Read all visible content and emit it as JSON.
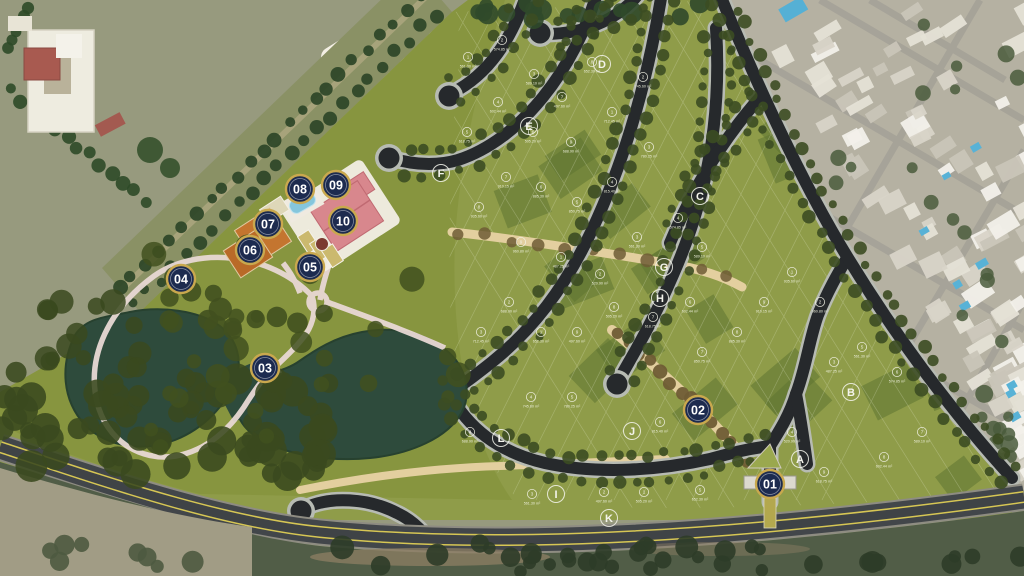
{
  "map": {
    "kind": "residential-masterplan-aerial",
    "colors": {
      "marker_fill": "#1d2b4f",
      "marker_ring": "#c9a84e",
      "marker_text": "#ffffff",
      "lot_light": "#93a248",
      "lot_dark": "#5f7531",
      "road_asphalt": "#26292c",
      "road_curb": "#b7bbb3",
      "main_road": "#42464a",
      "road_line_yellow": "#d6c654",
      "path_tan": "#e3cf9f",
      "water": "#2e4b3c",
      "roof_pink": "#d8878d",
      "court_orange": "#c4752f",
      "pool_blue": "#85c6dc",
      "white_path": "#ecddd6"
    },
    "markers": [
      {
        "id": "01",
        "x": 770,
        "y": 484
      },
      {
        "id": "02",
        "x": 698,
        "y": 410
      },
      {
        "id": "03",
        "x": 265,
        "y": 368
      },
      {
        "id": "04",
        "x": 181,
        "y": 279
      },
      {
        "id": "05",
        "x": 310,
        "y": 267
      },
      {
        "id": "06",
        "x": 250,
        "y": 250
      },
      {
        "id": "07",
        "x": 268,
        "y": 224
      },
      {
        "id": "08",
        "x": 300,
        "y": 189
      },
      {
        "id": "09",
        "x": 336,
        "y": 185
      },
      {
        "id": "10",
        "x": 343,
        "y": 221
      }
    ],
    "blocks": [
      {
        "id": "A",
        "x": 800,
        "y": 459
      },
      {
        "id": "B",
        "x": 851,
        "y": 392
      },
      {
        "id": "C",
        "x": 700,
        "y": 196
      },
      {
        "id": "D",
        "x": 602,
        "y": 64
      },
      {
        "id": "E",
        "x": 529,
        "y": 126
      },
      {
        "id": "F",
        "x": 441,
        "y": 173
      },
      {
        "id": "G",
        "x": 664,
        "y": 267
      },
      {
        "id": "H",
        "x": 660,
        "y": 298
      },
      {
        "id": "I",
        "x": 556,
        "y": 494
      },
      {
        "id": "J",
        "x": 632,
        "y": 431
      },
      {
        "id": "K",
        "x": 609,
        "y": 518
      },
      {
        "id": "L",
        "x": 501,
        "y": 438
      }
    ],
    "lots": [
      {
        "n": "1",
        "area": "561.30 m²",
        "x": 468,
        "y": 57
      },
      {
        "n": "2",
        "area": "574.85 m²",
        "x": 502,
        "y": 40
      },
      {
        "n": "3",
        "area": "589.10 m²",
        "x": 534,
        "y": 74
      },
      {
        "n": "4",
        "area": "602.44 m²",
        "x": 498,
        "y": 102
      },
      {
        "n": "5",
        "area": "618.75 m²",
        "x": 467,
        "y": 132
      },
      {
        "n": "6",
        "area": "505.20 m²",
        "x": 533,
        "y": 132
      },
      {
        "n": "7",
        "area": "497.60 m²",
        "x": 562,
        "y": 97
      },
      {
        "n": "8",
        "area": "652.30 m²",
        "x": 592,
        "y": 62
      },
      {
        "n": "9",
        "area": "688.90 m²",
        "x": 571,
        "y": 142
      },
      {
        "n": "1",
        "area": "712.45 m²",
        "x": 612,
        "y": 112
      },
      {
        "n": "2",
        "area": "745.60 m²",
        "x": 643,
        "y": 77
      },
      {
        "n": "3",
        "area": "780.25 m²",
        "x": 649,
        "y": 147
      },
      {
        "n": "4",
        "area": "815.40 m²",
        "x": 612,
        "y": 182
      },
      {
        "n": "5",
        "area": "850.75 m²",
        "x": 577,
        "y": 202
      },
      {
        "n": "6",
        "area": "885.30 m²",
        "x": 541,
        "y": 187
      },
      {
        "n": "7",
        "area": "910.15 m²",
        "x": 506,
        "y": 177
      },
      {
        "n": "8",
        "area": "935.60 m²",
        "x": 479,
        "y": 207
      },
      {
        "n": "9",
        "area": "960.80 m²",
        "x": 521,
        "y": 242
      },
      {
        "n": "1",
        "area": "487.25 m²",
        "x": 561,
        "y": 257
      },
      {
        "n": "2",
        "area": "520.90 m²",
        "x": 600,
        "y": 274
      },
      {
        "n": "3",
        "area": "561.30 m²",
        "x": 637,
        "y": 237
      },
      {
        "n": "4",
        "area": "574.85 m²",
        "x": 678,
        "y": 218
      },
      {
        "n": "5",
        "area": "589.10 m²",
        "x": 702,
        "y": 247
      },
      {
        "n": "6",
        "area": "602.44 m²",
        "x": 690,
        "y": 302
      },
      {
        "n": "7",
        "area": "618.75 m²",
        "x": 653,
        "y": 317
      },
      {
        "n": "8",
        "area": "505.20 m²",
        "x": 614,
        "y": 307
      },
      {
        "n": "9",
        "area": "497.60 m²",
        "x": 577,
        "y": 332
      },
      {
        "n": "1",
        "area": "652.30 m²",
        "x": 541,
        "y": 332
      },
      {
        "n": "2",
        "area": "688.90 m²",
        "x": 509,
        "y": 302
      },
      {
        "n": "3",
        "area": "712.45 m²",
        "x": 481,
        "y": 332
      },
      {
        "n": "4",
        "area": "745.60 m²",
        "x": 531,
        "y": 397
      },
      {
        "n": "5",
        "area": "780.25 m²",
        "x": 572,
        "y": 397
      },
      {
        "n": "6",
        "area": "815.40 m²",
        "x": 660,
        "y": 422
      },
      {
        "n": "7",
        "area": "850.75 m²",
        "x": 702,
        "y": 352
      },
      {
        "n": "8",
        "area": "885.30 m²",
        "x": 737,
        "y": 332
      },
      {
        "n": "9",
        "area": "910.15 m²",
        "x": 764,
        "y": 302
      },
      {
        "n": "1",
        "area": "935.60 m²",
        "x": 792,
        "y": 272
      },
      {
        "n": "2",
        "area": "960.80 m²",
        "x": 820,
        "y": 302
      },
      {
        "n": "3",
        "area": "487.25 m²",
        "x": 834,
        "y": 362
      },
      {
        "n": "4",
        "area": "520.90 m²",
        "x": 792,
        "y": 432
      },
      {
        "n": "5",
        "area": "561.30 m²",
        "x": 862,
        "y": 347
      },
      {
        "n": "6",
        "area": "574.85 m²",
        "x": 897,
        "y": 372
      },
      {
        "n": "7",
        "area": "589.10 m²",
        "x": 922,
        "y": 432
      },
      {
        "n": "8",
        "area": "602.44 m²",
        "x": 884,
        "y": 457
      },
      {
        "n": "9",
        "area": "618.75 m²",
        "x": 824,
        "y": 472
      },
      {
        "n": "1",
        "area": "505.20 m²",
        "x": 644,
        "y": 492
      },
      {
        "n": "2",
        "area": "497.60 m²",
        "x": 604,
        "y": 492
      },
      {
        "n": "3",
        "area": "561.30 m²",
        "x": 532,
        "y": 494
      },
      {
        "n": "4",
        "area": "688.90 m²",
        "x": 470,
        "y": 432
      },
      {
        "n": "5",
        "area": "652.30 m²",
        "x": 700,
        "y": 490
      }
    ]
  }
}
